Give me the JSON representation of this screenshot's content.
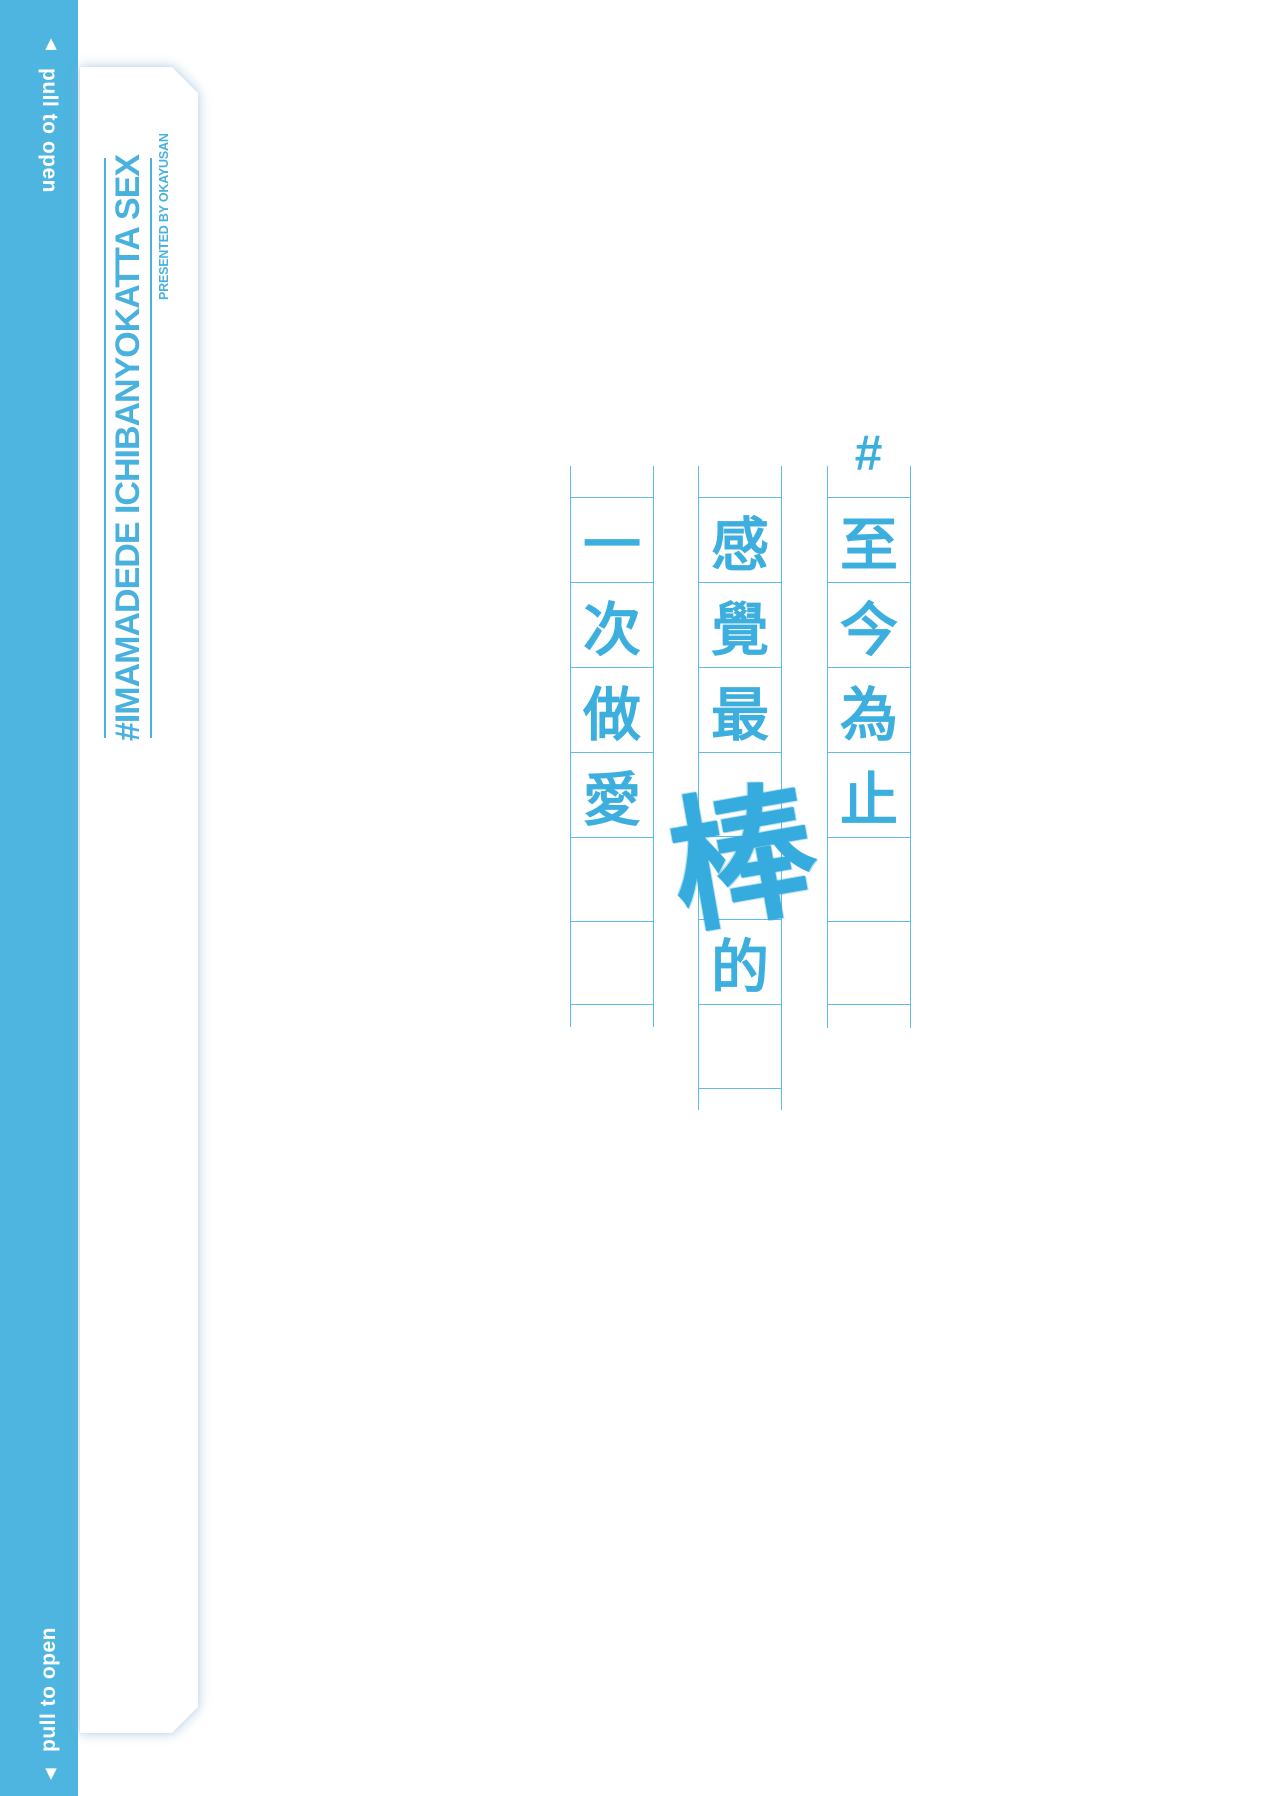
{
  "colors": {
    "spine_blue": "#4db5e0",
    "grid_line_blue": "#5fbce3",
    "glyph_blue": "#3cafdf",
    "title_blue": "#48b1de",
    "background": "#ffffff"
  },
  "spine": {
    "top_arrow": "▲",
    "top_label": "pull to open",
    "bottom_label": "pull to open",
    "bottom_arrow": "▼"
  },
  "cover": {
    "title": "#IMAMADEDE ICHIBANYOKATTA SEX",
    "credit": "PRESENTED BY OKAYUSAN"
  },
  "manuscript": {
    "hashtag": "#",
    "phrase": "#至今為止感覺最棒的一次做愛",
    "scribble_char": "棒",
    "columns": [
      {
        "position": "right",
        "chars": [
          "至",
          "今",
          "為",
          "止",
          "",
          ""
        ]
      },
      {
        "position": "middle",
        "chars": [
          "感",
          "覺",
          "最",
          "",
          "",
          "的",
          ""
        ]
      },
      {
        "position": "left",
        "chars": [
          "一",
          "次",
          "做",
          "愛",
          "",
          ""
        ]
      }
    ]
  }
}
